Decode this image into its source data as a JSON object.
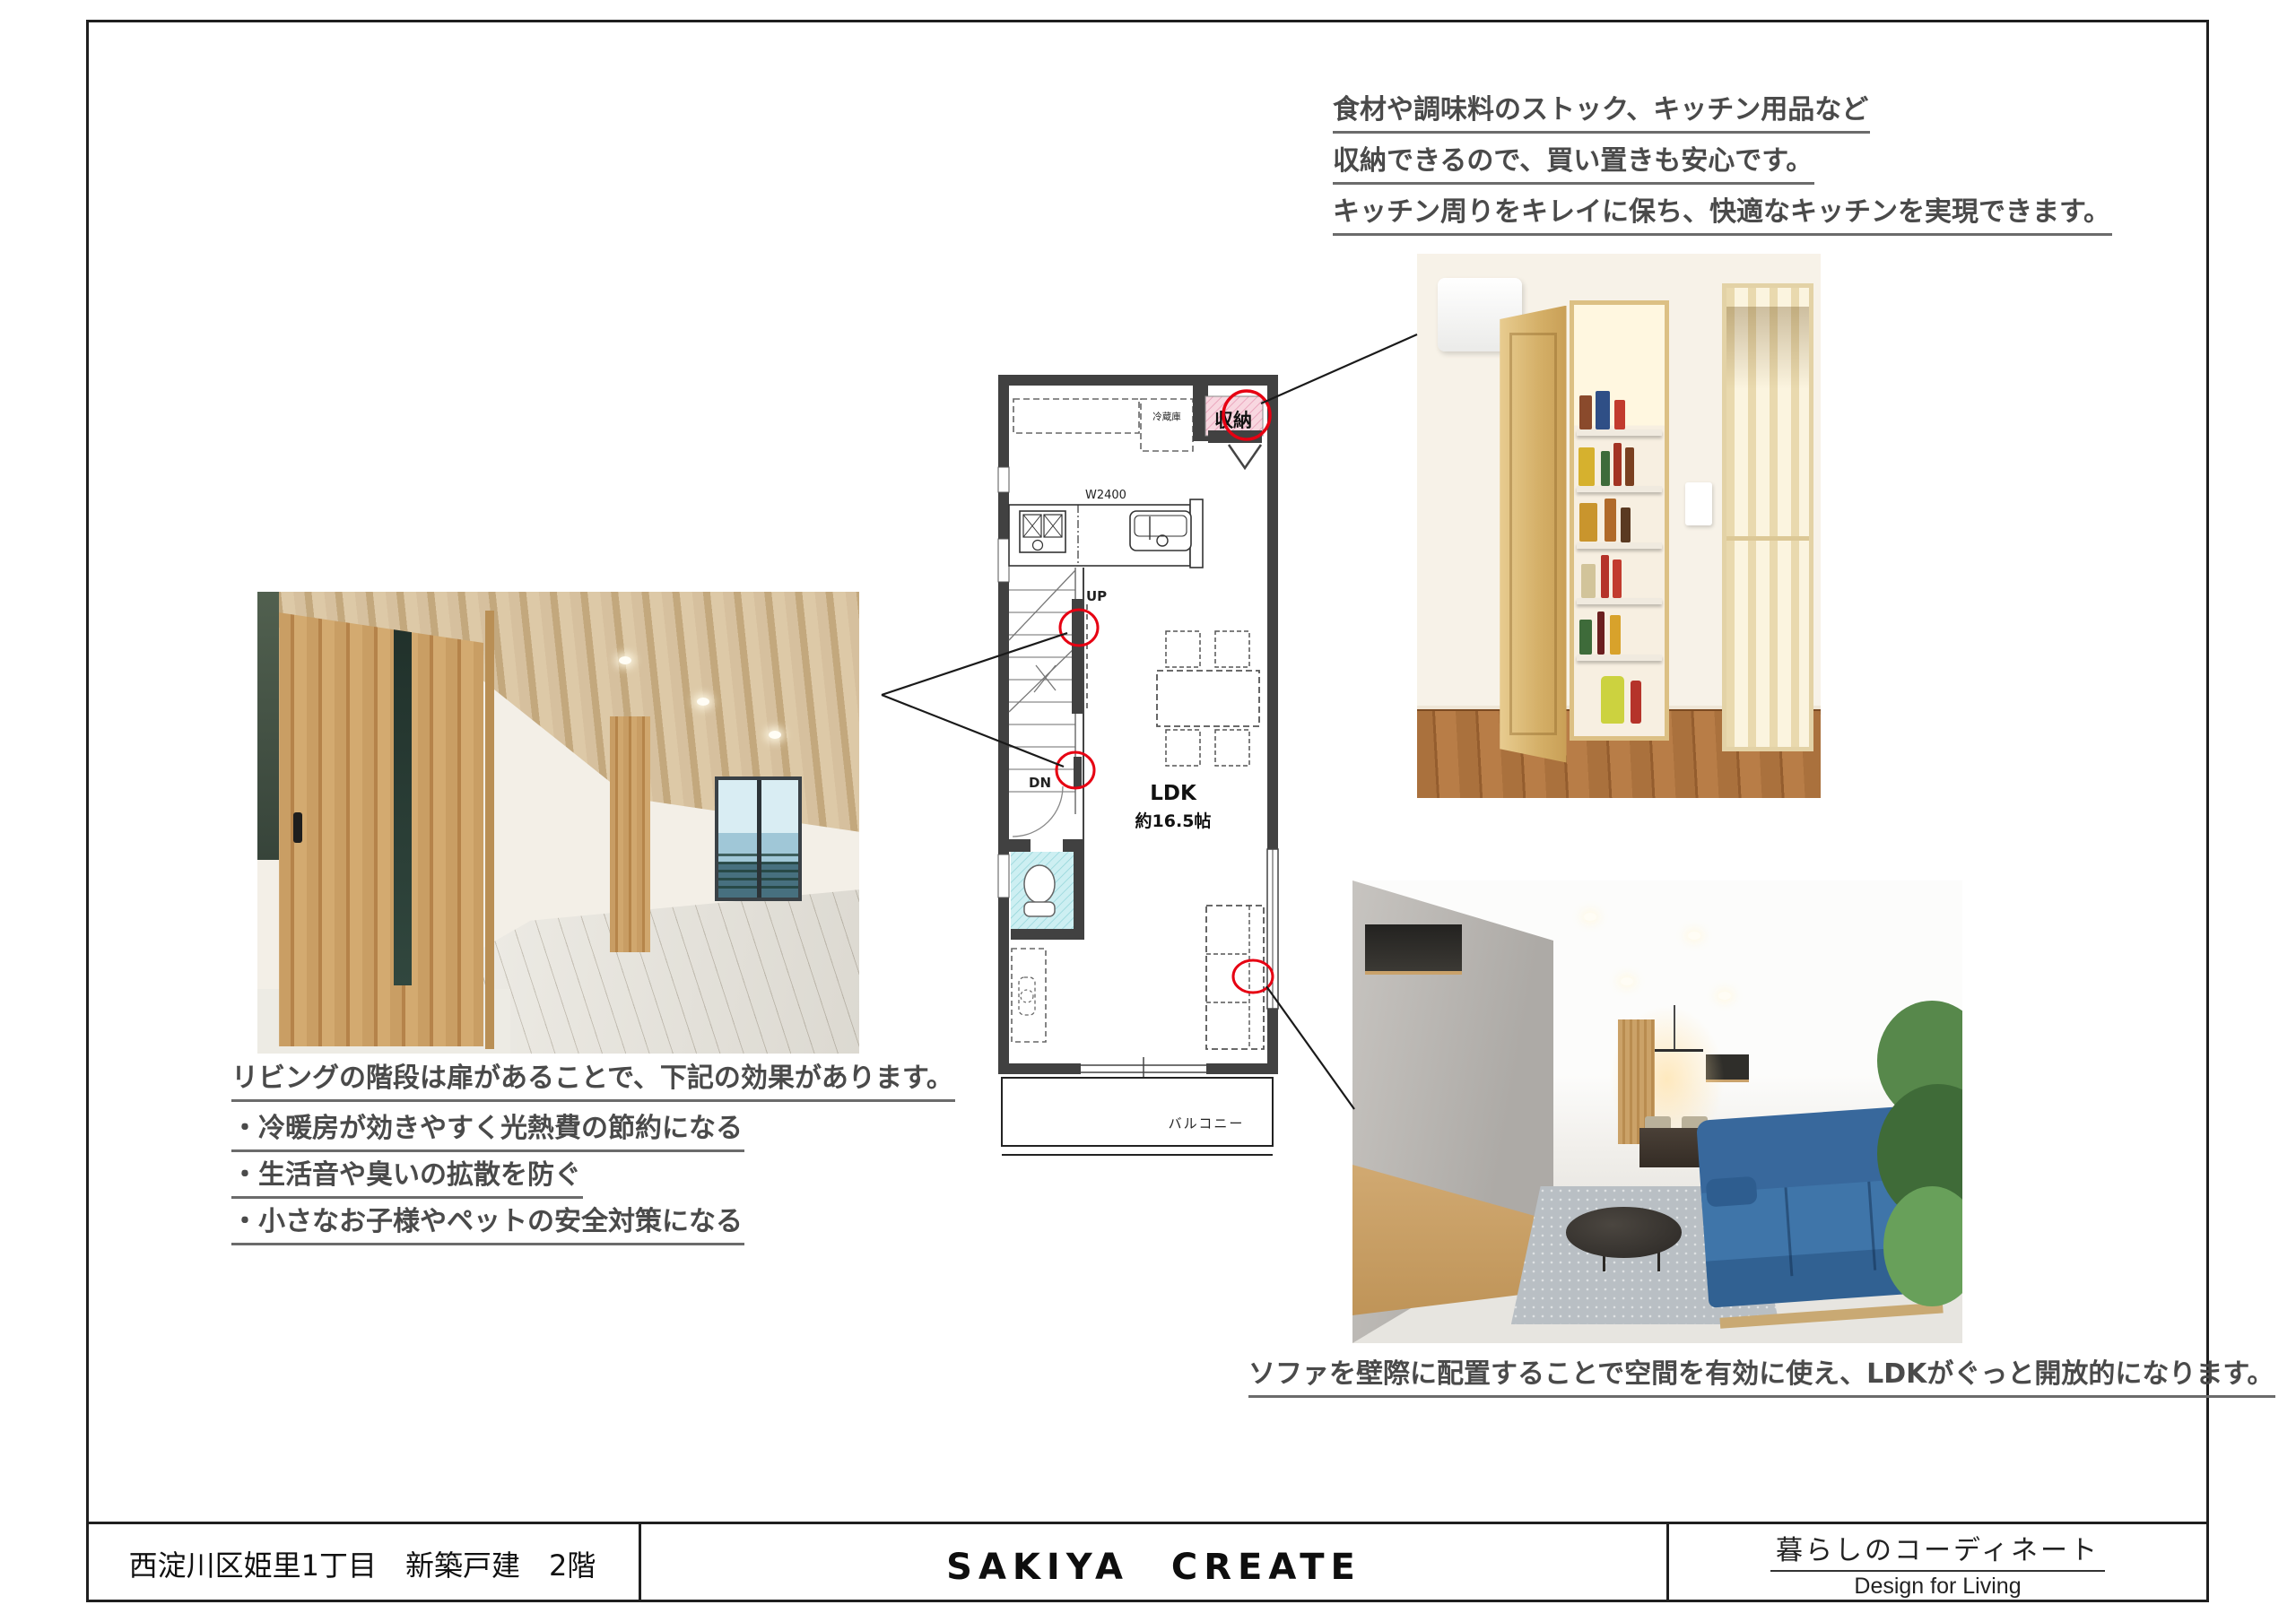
{
  "annotations": {
    "kitchen_note": {
      "line1": "食材や調味料のストック、キッチン用品など",
      "line2": "収納できるので、買い置きも安心です。",
      "line3": "キッチン周りをキレイに保ち、快適なキッチンを実現できます。"
    },
    "stairs_note": {
      "line1": "リビングの階段は扉があることで、下記の効果があります。",
      "line2": "・冷暖房が効きやすく光熱費の節約になる",
      "line3": "・生活音や臭いの拡散を防ぐ",
      "line4": "・小さなお子様やペットの安全対策になる"
    },
    "sofa_note": "ソファを壁際に配置することで空間を有効に使え、LDKがぐっと開放的になります。"
  },
  "floor_plan": {
    "storage": "収納",
    "fridge": "冷蔵庫",
    "counter_width": "W2400",
    "up": "UP",
    "down": "DN",
    "room_name": "LDK",
    "room_size": "約16.5帖",
    "balcony": "バルコニー"
  },
  "footer": {
    "left": "西淀川区姫里1丁目　新築戸建　2階",
    "center": "SAKIYA　CREATE",
    "right_title": "暮らしのコーディネート",
    "right_subtitle": "Design for Living"
  },
  "colors": {
    "annotation_text": "#4a4a4a",
    "wall": "#414141",
    "highlight_red": "#e60012",
    "storage_pink": "#f8d7e0",
    "toilet_cyan": "#cdeff2",
    "sofa_blue": "#3a6f9f"
  }
}
